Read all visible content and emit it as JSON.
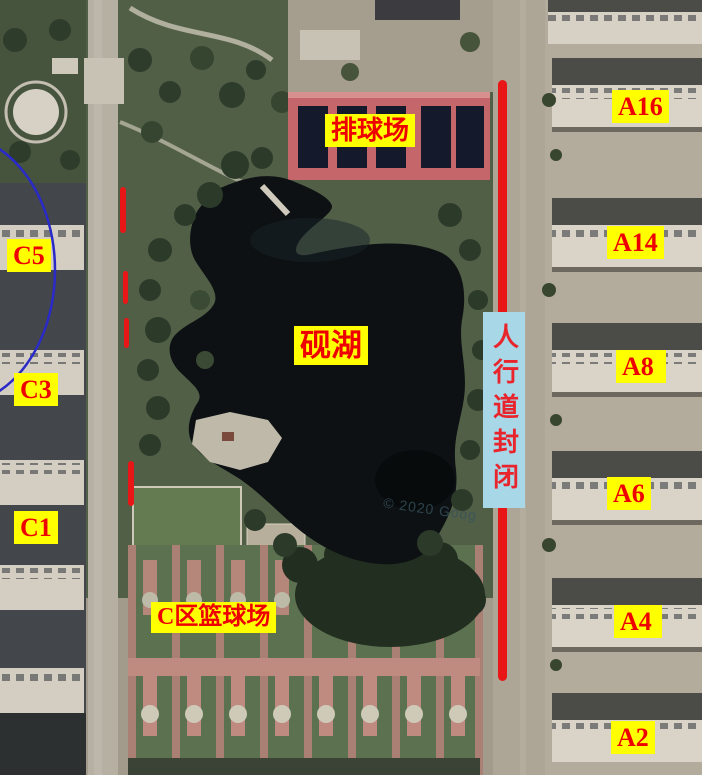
{
  "map_overlay": {
    "area_labels": {
      "volleyball": "排球场",
      "lake": "砚湖",
      "basketball": "C区篮球场"
    },
    "sidewalk_banner": "人行道封闭",
    "building_labels": {
      "c5": "C5",
      "c3": "C3",
      "c1": "C1",
      "a16": "A16",
      "a14": "A14",
      "a8": "A8",
      "a6": "A6",
      "a4": "A4",
      "a2": "A2"
    },
    "watermark": "© 2020 Goog",
    "colors": {
      "label_background": "#ffff00",
      "label_text": "#ee0000",
      "banner_background": "#a8d8e8",
      "closed_route_red": "#e81616",
      "zone_ellipse_blue": "#2a2ac8"
    }
  }
}
